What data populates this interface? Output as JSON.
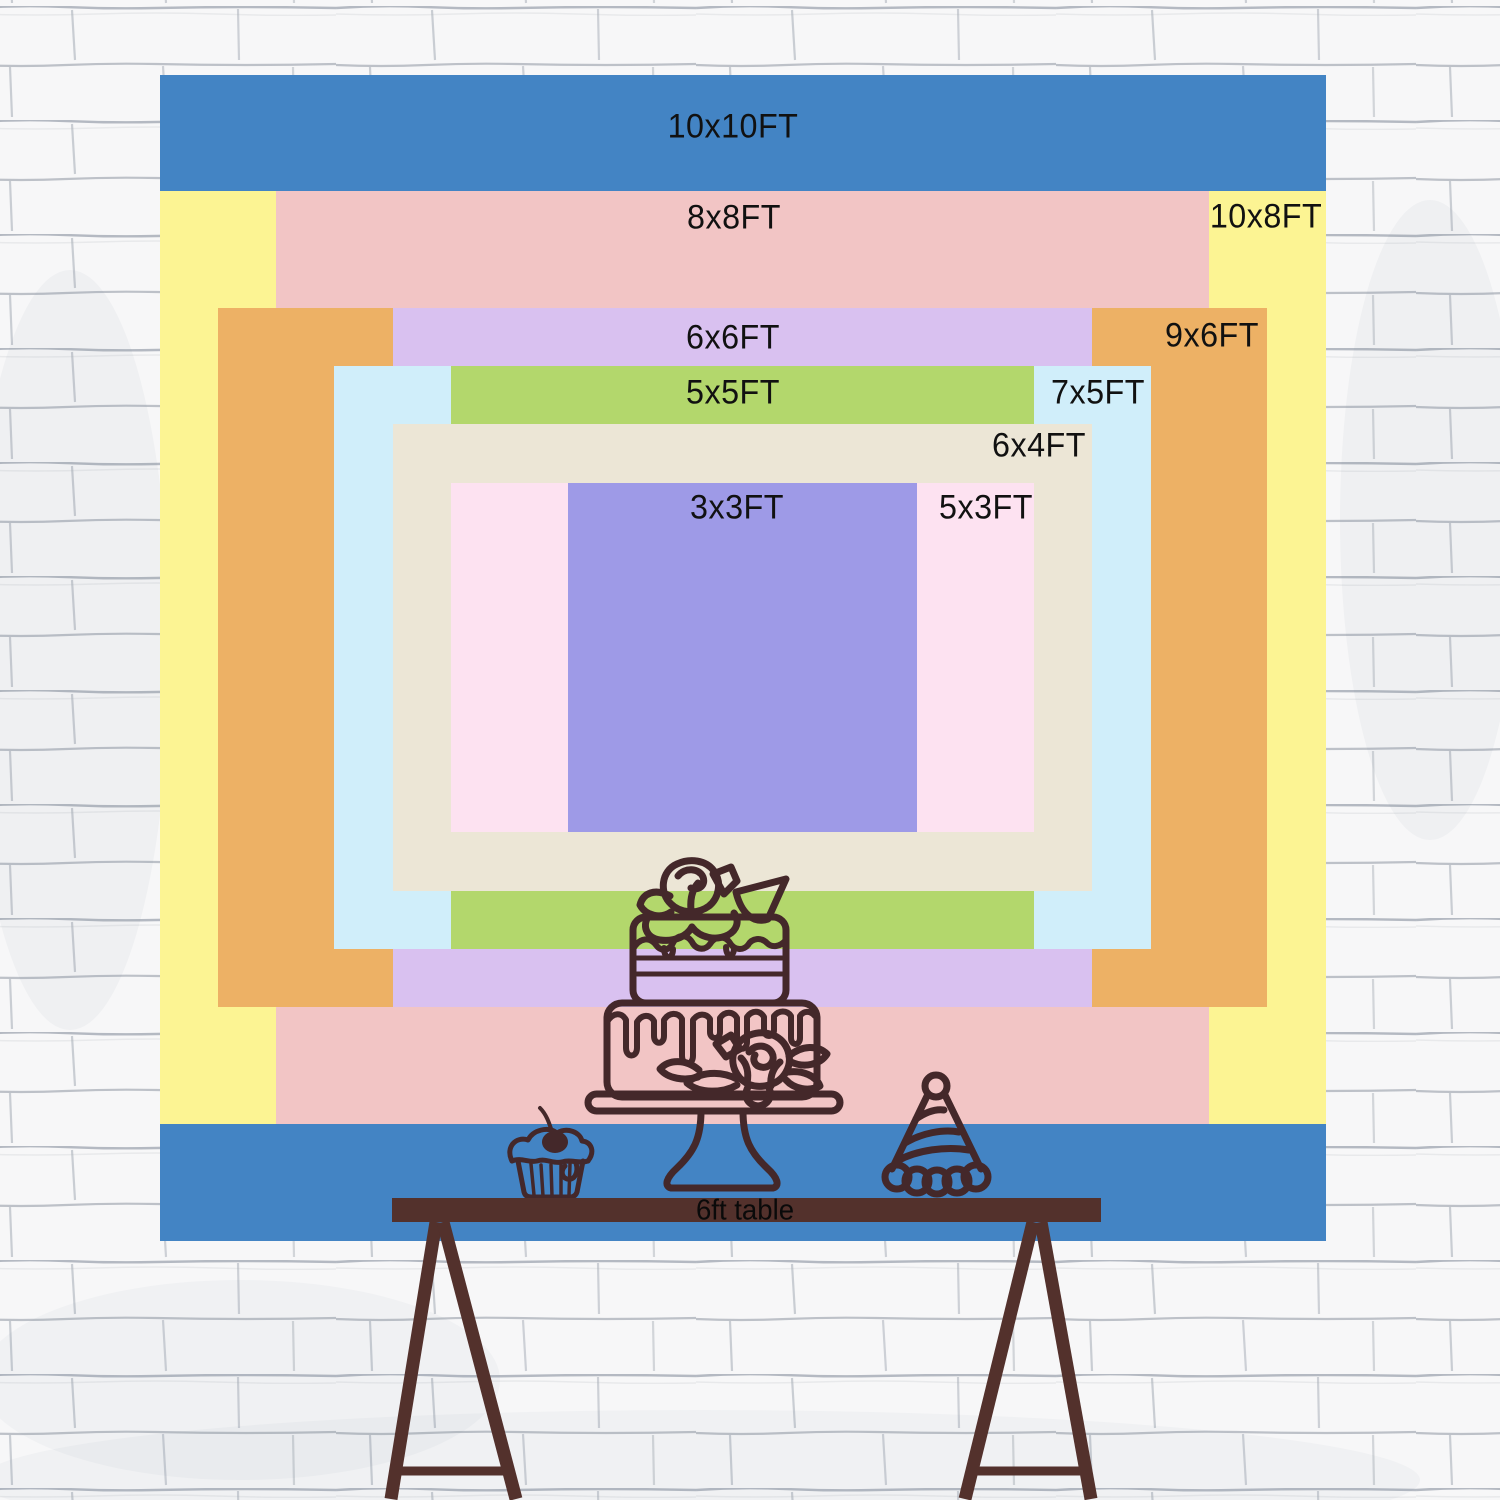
{
  "backdrop": {
    "px_per_ft": 116.6,
    "center_px": {
      "x": 742.5,
      "y": 657.5
    },
    "label_color": "#111111",
    "sizes": [
      {
        "id": "10x10ft",
        "label": "10x10FT",
        "width_ft": 10,
        "height_ft": 10,
        "color": "#4384c4",
        "label_px": {
          "x": 733,
          "y": 127
        }
      },
      {
        "id": "10x8ft",
        "label": "10x8FT",
        "width_ft": 10,
        "height_ft": 8,
        "color": "#fcf493",
        "label_px": {
          "x": 1266,
          "y": 217
        }
      },
      {
        "id": "8x8ft",
        "label": "8x8FT",
        "width_ft": 8,
        "height_ft": 8,
        "color": "#f2c5c5",
        "label_px": {
          "x": 734,
          "y": 218
        }
      },
      {
        "id": "9x6ft",
        "label": "9x6FT",
        "width_ft": 9,
        "height_ft": 6,
        "color": "#edb165",
        "label_px": {
          "x": 1212,
          "y": 336
        }
      },
      {
        "id": "6x6ft",
        "label": "6x6FT",
        "width_ft": 6,
        "height_ft": 6,
        "color": "#d9c1f0",
        "label_px": {
          "x": 733,
          "y": 338
        }
      },
      {
        "id": "7x5ft",
        "label": "7x5FT",
        "width_ft": 7,
        "height_ft": 5,
        "color": "#d0eefa",
        "label_px": {
          "x": 1098,
          "y": 393
        }
      },
      {
        "id": "5x5ft",
        "label": "5x5FT",
        "width_ft": 5,
        "height_ft": 5,
        "color": "#b3d76c",
        "label_px": {
          "x": 733,
          "y": 393
        }
      },
      {
        "id": "6x4ft",
        "label": "6x4FT",
        "width_ft": 6,
        "height_ft": 4,
        "color": "#ece6d6",
        "label_px": {
          "x": 1039,
          "y": 446
        }
      },
      {
        "id": "5x3ft",
        "label": "5x3FT",
        "width_ft": 5,
        "height_ft": 3,
        "color": "#fde2f1",
        "label_px": {
          "x": 986,
          "y": 508
        }
      },
      {
        "id": "3x3ft",
        "label": "3x3FT",
        "width_ft": 3,
        "height_ft": 3,
        "color": "#9e9ae7",
        "label_px": {
          "x": 737,
          "y": 508
        }
      }
    ]
  },
  "table": {
    "label": "6ft table",
    "color": "#53312c",
    "bar_px": {
      "x": 392,
      "y": 1198,
      "width": 709,
      "height": 24
    },
    "label_px": {
      "x": 745,
      "y": 1211
    },
    "label_color": "#0a0a0a"
  },
  "decor": {
    "line_color": "#44282a",
    "items": [
      "birthday cake on stand",
      "cupcake with cherry",
      "party hat",
      "trestle table legs"
    ]
  },
  "wall": {
    "base_color": "#f7f7f8",
    "mortar_line_color": "#a4aab4"
  }
}
